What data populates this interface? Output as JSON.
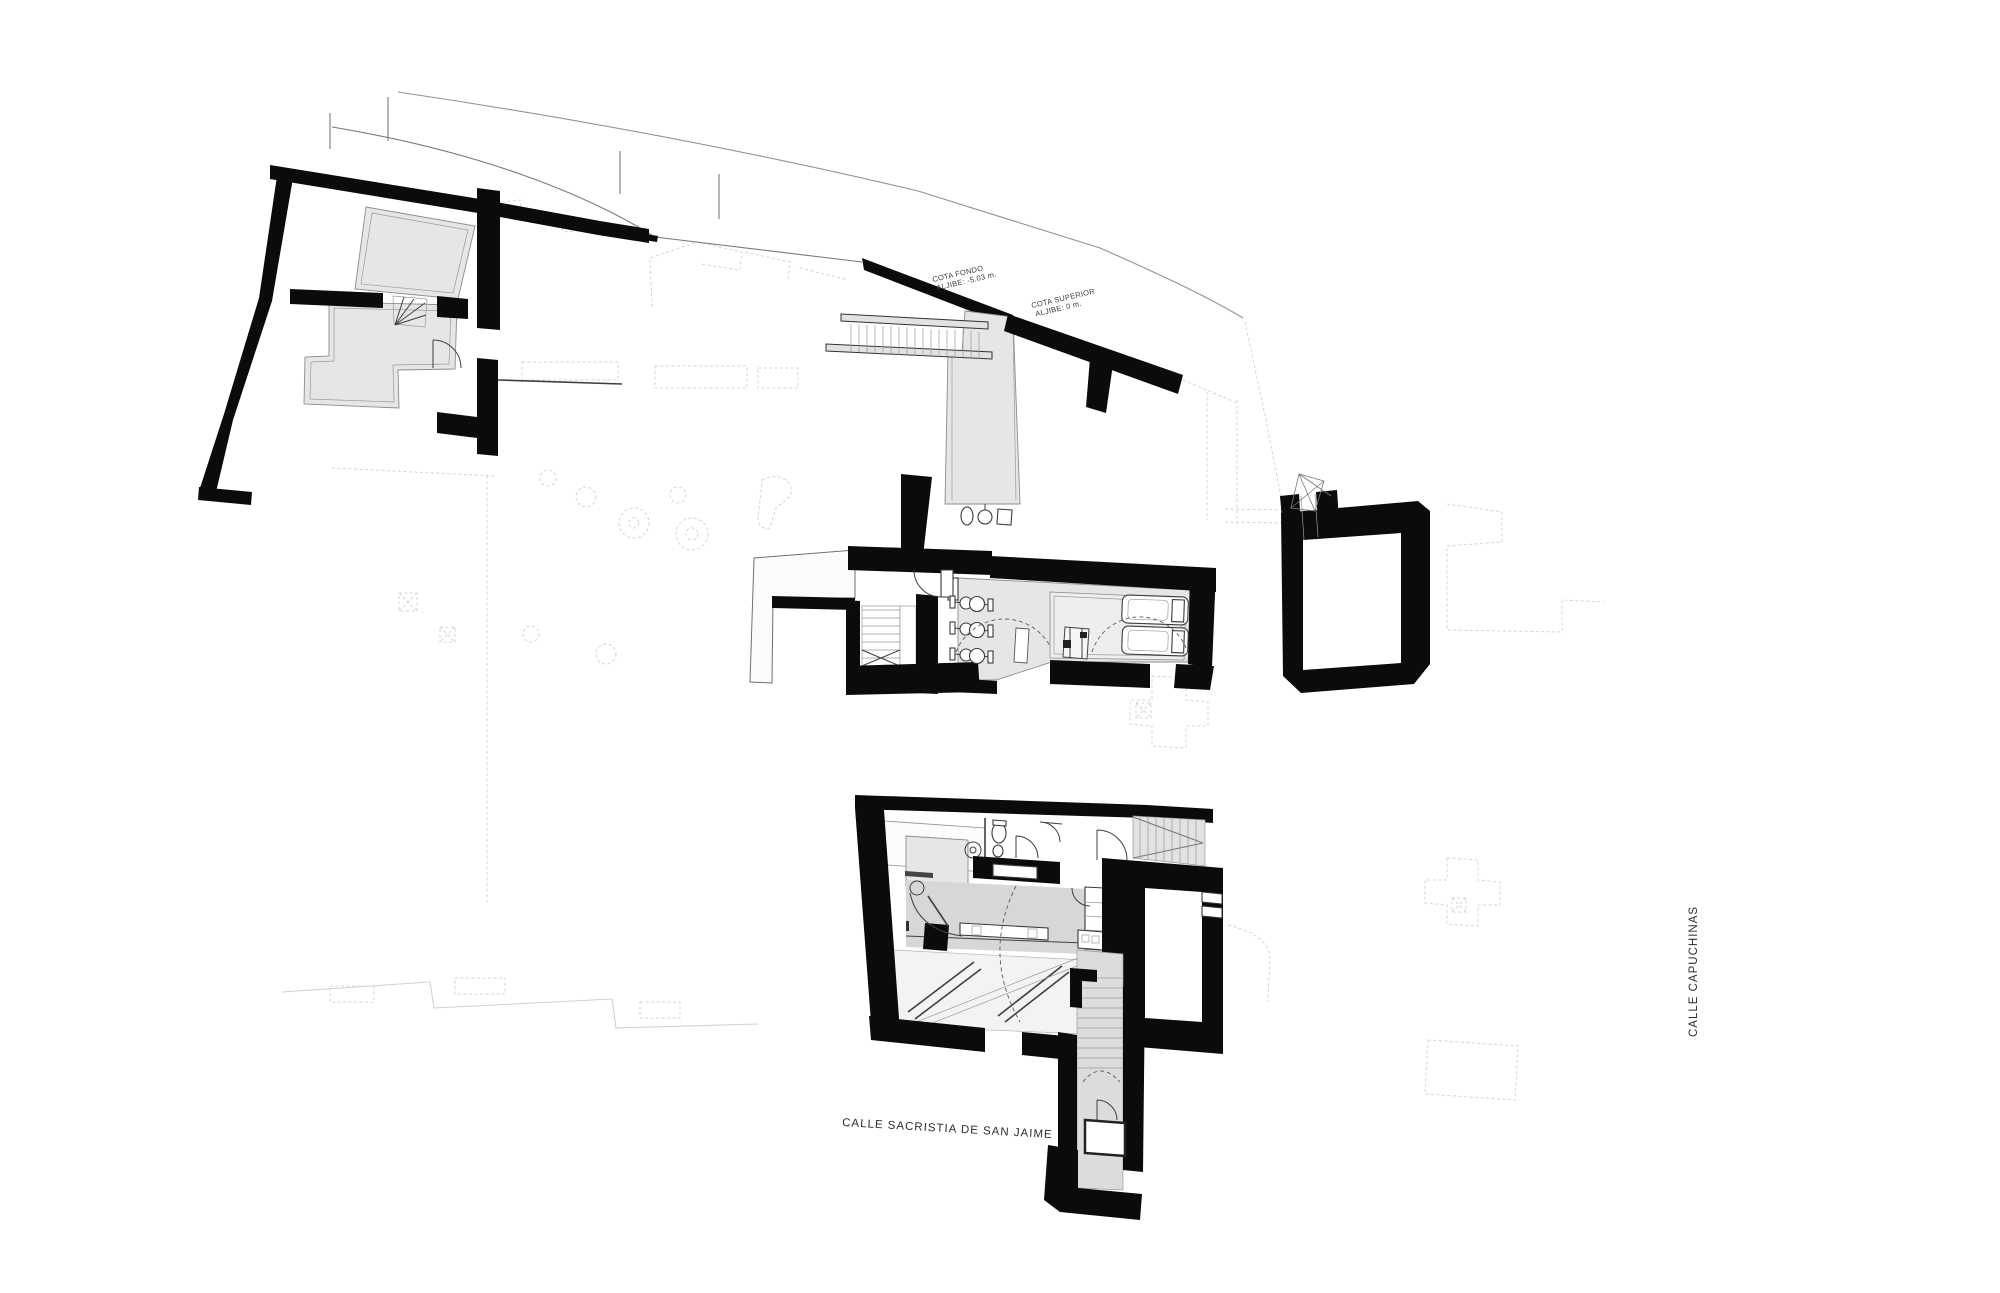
{
  "labels": {
    "south_street": "CALLE SACRISTIA DE SAN JAIME",
    "east_street": "CALLE CAPUCHINAS"
  },
  "annotations": {
    "cota_fondo": {
      "line1": "COTA FONDO",
      "line2": "ALJIBE: -5.03 m."
    },
    "cota_superior": {
      "line1": "COTA SUPERIOR",
      "line2": "ALJIBE: 0 m."
    }
  },
  "colors": {
    "wall": "#0b0b0b",
    "room_fill": "#e6e6e6",
    "floor_fill": "#d7d7d7",
    "detail_line": "#3f3f3f",
    "context_line": "#d2d2d2",
    "background": "#ffffff"
  }
}
